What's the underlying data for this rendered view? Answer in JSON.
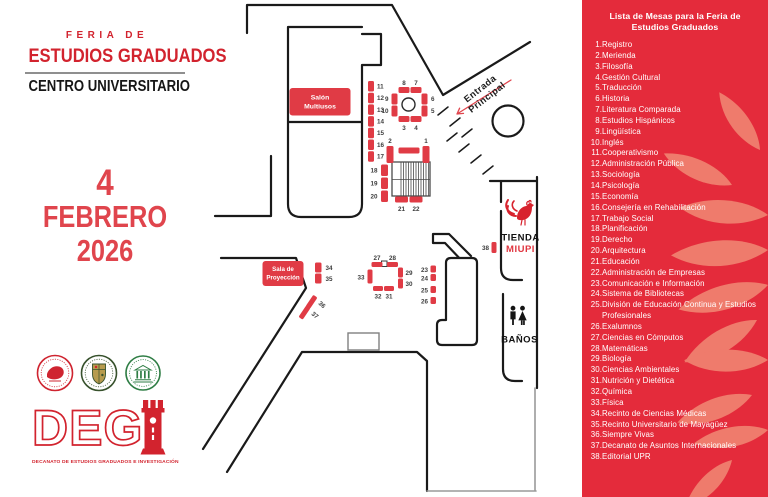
{
  "header": {
    "kicker": "FERIA DE",
    "title": "ESTUDIOS GRADUADOS",
    "subtitle": "CENTRO UNIVERSITARIO"
  },
  "date": {
    "day": "4",
    "month": "FEBRERO",
    "year": "2026"
  },
  "degi": {
    "logo_text": "DEG",
    "tagline": "DECANATO DE ESTUDIOS GRADUADOS E INVESTIGACIÓN"
  },
  "map": {
    "rooms": {
      "salon": [
        "Salón",
        "Multiusos"
      ],
      "sala_proyeccion": [
        "Sala de",
        "Proyección"
      ],
      "entrada": [
        "Entrada",
        "Principal"
      ],
      "tienda": "TIENDA",
      "miupi": "MIUPI",
      "banos": "BAÑOS"
    },
    "tables": [
      {
        "n": "1",
        "x": 422.5,
        "y": 146,
        "w": 7,
        "h": 17,
        "lx": 426,
        "ly": 143,
        "a": "middle"
      },
      {
        "n": "2",
        "x": 386.5,
        "y": 146,
        "w": 7,
        "h": 17,
        "lx": 390,
        "ly": 143,
        "a": "middle"
      },
      {
        "n": "",
        "x": 398.5,
        "y": 147.5,
        "w": 21,
        "h": 6
      },
      {
        "n": "3",
        "x": 398.5,
        "y": 116,
        "w": 11,
        "h": 6,
        "lx": 404,
        "ly": 130,
        "a": "middle"
      },
      {
        "n": "4",
        "x": 410.5,
        "y": 116,
        "w": 11,
        "h": 6,
        "lx": 416,
        "ly": 130,
        "a": "middle"
      },
      {
        "n": "5",
        "x": 421.5,
        "y": 105.5,
        "w": 6,
        "h": 11,
        "lx": 431,
        "ly": 113,
        "a": "start"
      },
      {
        "n": "6",
        "x": 421.5,
        "y": 93.5,
        "w": 6,
        "h": 11,
        "lx": 431,
        "ly": 101,
        "a": "start"
      },
      {
        "n": "7",
        "x": 410.5,
        "y": 87,
        "w": 11,
        "h": 6,
        "lx": 416,
        "ly": 85,
        "a": "middle"
      },
      {
        "n": "8",
        "x": 398.5,
        "y": 87,
        "w": 11,
        "h": 6,
        "lx": 404,
        "ly": 85,
        "a": "middle"
      },
      {
        "n": "9",
        "x": 391.5,
        "y": 93.5,
        "w": 6,
        "h": 11,
        "lx": 388.5,
        "ly": 101,
        "a": "end"
      },
      {
        "n": "10",
        "x": 391.5,
        "y": 105.5,
        "w": 6,
        "h": 11,
        "lx": 388.5,
        "ly": 113,
        "a": "end"
      },
      {
        "n": "11",
        "x": 368,
        "y": 81,
        "w": 6,
        "h": 10.5,
        "lx": 377,
        "ly": 88.5,
        "a": "start"
      },
      {
        "n": "12",
        "x": 368,
        "y": 92.7,
        "w": 6,
        "h": 10.5,
        "lx": 377,
        "ly": 100,
        "a": "start"
      },
      {
        "n": "13",
        "x": 368,
        "y": 104.4,
        "w": 6,
        "h": 10.5,
        "lx": 377,
        "ly": 112,
        "a": "start"
      },
      {
        "n": "14",
        "x": 368,
        "y": 116.1,
        "w": 6,
        "h": 10.5,
        "lx": 377,
        "ly": 123.5,
        "a": "start"
      },
      {
        "n": "15",
        "x": 368,
        "y": 127.8,
        "w": 6,
        "h": 10.5,
        "lx": 377,
        "ly": 135,
        "a": "start"
      },
      {
        "n": "16",
        "x": 368,
        "y": 139.5,
        "w": 6,
        "h": 10.5,
        "lx": 377,
        "ly": 147,
        "a": "start"
      },
      {
        "n": "17",
        "x": 368,
        "y": 151.2,
        "w": 6,
        "h": 10.5,
        "lx": 377,
        "ly": 158.5,
        "a": "start"
      },
      {
        "n": "18",
        "x": 381,
        "y": 164.5,
        "w": 7,
        "h": 11.5,
        "lx": 377.5,
        "ly": 172.5,
        "a": "end"
      },
      {
        "n": "19",
        "x": 381,
        "y": 177.5,
        "w": 7,
        "h": 11.5,
        "lx": 377.5,
        "ly": 185.5,
        "a": "end"
      },
      {
        "n": "20",
        "x": 381,
        "y": 190.5,
        "w": 7,
        "h": 11.5,
        "lx": 377.5,
        "ly": 198.5,
        "a": "end"
      },
      {
        "n": "21",
        "x": 395,
        "y": 196.5,
        "w": 13,
        "h": 6,
        "lx": 401.5,
        "ly": 211,
        "a": "middle"
      },
      {
        "n": "22",
        "x": 409.5,
        "y": 196.5,
        "w": 13,
        "h": 6,
        "lx": 416,
        "ly": 211,
        "a": "middle"
      },
      {
        "n": "23",
        "x": 430.5,
        "y": 265.5,
        "w": 5.5,
        "h": 7,
        "lx": 428,
        "ly": 272,
        "a": "end"
      },
      {
        "n": "24",
        "x": 430.5,
        "y": 274,
        "w": 5.5,
        "h": 7,
        "lx": 428,
        "ly": 280.5,
        "a": "end"
      },
      {
        "n": "25",
        "x": 430.5,
        "y": 286,
        "w": 5.5,
        "h": 7,
        "lx": 428,
        "ly": 292.5,
        "a": "end"
      },
      {
        "n": "26",
        "x": 430.5,
        "y": 297,
        "w": 5.5,
        "h": 7,
        "lx": 428,
        "ly": 303.5,
        "a": "end"
      },
      {
        "n": "27",
        "x": 371.5,
        "y": 262,
        "w": 11,
        "h": 5,
        "lx": 377,
        "ly": 260,
        "a": "middle"
      },
      {
        "n": "28",
        "x": 387,
        "y": 262,
        "w": 11,
        "h": 5,
        "lx": 392.5,
        "ly": 260,
        "a": "middle"
      },
      {
        "n": "29",
        "x": 398,
        "y": 267.5,
        "w": 5,
        "h": 10,
        "lx": 405.5,
        "ly": 275,
        "a": "start"
      },
      {
        "n": "30",
        "x": 398,
        "y": 278.5,
        "w": 5,
        "h": 10,
        "lx": 405.5,
        "ly": 286,
        "a": "start"
      },
      {
        "n": "31",
        "x": 384,
        "y": 286,
        "w": 10,
        "h": 5,
        "lx": 389,
        "ly": 298.5,
        "a": "middle"
      },
      {
        "n": "32",
        "x": 373,
        "y": 286,
        "w": 10,
        "h": 5,
        "lx": 378,
        "ly": 298.5,
        "a": "middle"
      },
      {
        "n": "33",
        "x": 367.5,
        "y": 269.5,
        "w": 5,
        "h": 14,
        "lx": 364.5,
        "ly": 279.5,
        "a": "end"
      },
      {
        "n": "34",
        "x": 315,
        "y": 262.5,
        "w": 6.5,
        "h": 10,
        "lx": 325.5,
        "ly": 270,
        "a": "start"
      },
      {
        "n": "35",
        "x": 315,
        "y": 273.5,
        "w": 6.5,
        "h": 10,
        "lx": 325.5,
        "ly": 281,
        "a": "start"
      },
      {
        "n": "36",
        "x": 309,
        "y": 295,
        "w": 5,
        "h": 14,
        "rot": 34,
        "lx": 318,
        "ly": 304,
        "a": "start",
        "lrot": 40
      },
      {
        "n": "37",
        "x": 302,
        "y": 305.5,
        "w": 5,
        "h": 14,
        "rot": 34,
        "lx": 311,
        "ly": 314.5,
        "a": "start",
        "lrot": 40
      },
      {
        "n": "38",
        "x": 491.5,
        "y": 242,
        "w": 5,
        "h": 11,
        "lx": 489,
        "ly": 250,
        "a": "end"
      }
    ]
  },
  "panel": {
    "title_line1": "Lista de Mesas para la Feria de",
    "title_line2": "Estudios Graduados",
    "items": [
      {
        "n": "1",
        "label": "Registro"
      },
      {
        "n": "2",
        "label": "Merienda"
      },
      {
        "n": "3",
        "label": "Filosofía"
      },
      {
        "n": "4",
        "label": "Gestión Cultural"
      },
      {
        "n": "5",
        "label": "Traducción"
      },
      {
        "n": "6",
        "label": "Historia"
      },
      {
        "n": "7",
        "label": "Literatura Comparada"
      },
      {
        "n": "8",
        "label": "Estudios Hispánicos"
      },
      {
        "n": "9",
        "label": "Lingüística"
      },
      {
        "n": "10",
        "label": "Inglés"
      },
      {
        "n": "11",
        "label": "Cooperativismo"
      },
      {
        "n": "12",
        "label": "Administración Pública"
      },
      {
        "n": "13",
        "label": "Sociología"
      },
      {
        "n": "14",
        "label": "Psicología"
      },
      {
        "n": "15",
        "label": "Economía"
      },
      {
        "n": "16",
        "label": "Consejería en Rehabilitación"
      },
      {
        "n": "17",
        "label": "Trabajo Social"
      },
      {
        "n": "18",
        "label": "Planificación"
      },
      {
        "n": "19",
        "label": "Derecho"
      },
      {
        "n": "20",
        "label": "Arquitectura"
      },
      {
        "n": "21",
        "label": "Educación"
      },
      {
        "n": "22",
        "label": "Administración de Empresas"
      },
      {
        "n": "23",
        "label": "Comunicación e Información"
      },
      {
        "n": "24",
        "label": "Sistema de Bibliotecas"
      },
      {
        "n": "25",
        "label": "División de Educación Continua y Estudios Profesionales"
      },
      {
        "n": "26",
        "label": "Exalumnos"
      },
      {
        "n": "27",
        "label": "Ciencias en Cómputos"
      },
      {
        "n": "28",
        "label": "Matemáticas"
      },
      {
        "n": "29",
        "label": "Biología"
      },
      {
        "n": "30",
        "label": "Ciencias Ambientales"
      },
      {
        "n": "31",
        "label": "Nutrición y Dietética"
      },
      {
        "n": "32",
        "label": "Química"
      },
      {
        "n": "33",
        "label": "Física"
      },
      {
        "n": "34",
        "label": "Recinto de Ciencias Médicas"
      },
      {
        "n": "35",
        "label": "Recinto Universitario de Mayagüez"
      },
      {
        "n": "36",
        "label": "Siempre Vivas"
      },
      {
        "n": "37",
        "label": "Decanato de Asuntos Internacionales"
      },
      {
        "n": "38",
        "label": "Editorial UPR"
      }
    ]
  },
  "colors": {
    "panel_red": "#e42b3b",
    "leaf": "#ef7b6c",
    "map_red": "#e03b45",
    "title_red": "#d2232e",
    "date_red": "#e0454d",
    "black": "#1a1a1a"
  }
}
